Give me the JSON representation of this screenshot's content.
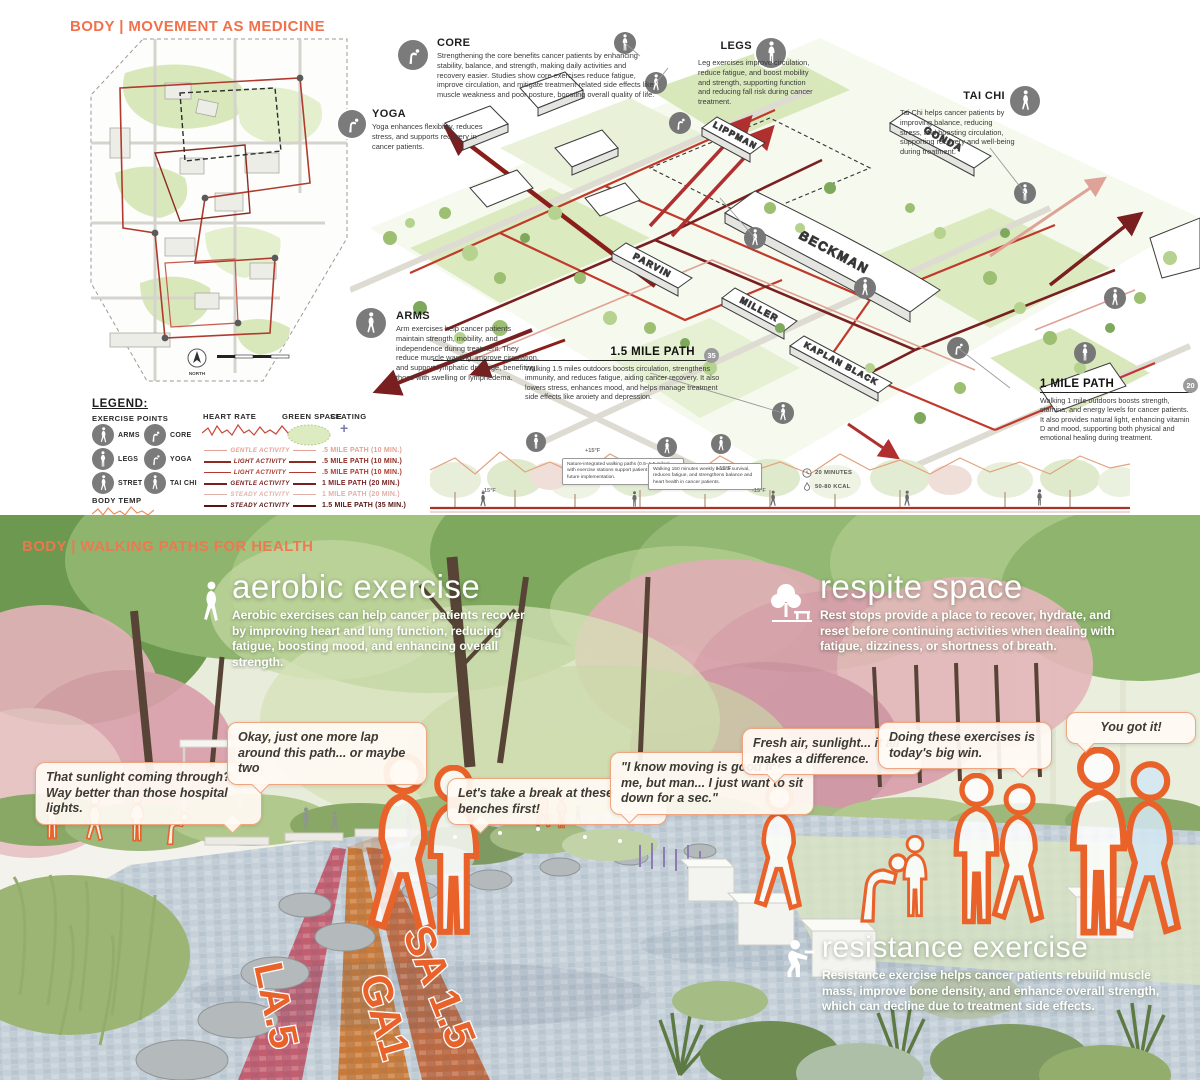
{
  "top": {
    "title": "BODY  |  MOVEMENT AS MEDICINE",
    "map": {
      "north_label": "NORTH"
    },
    "buildings": {
      "lippman": "LIPPMAN",
      "gonda": "GONDA",
      "beckman": "BECKMAN",
      "parvin": "PARVIN",
      "miller": "MILLER",
      "kaplan_black": "KAPLAN BLACK"
    },
    "callouts": {
      "core": {
        "title": "CORE",
        "text": "Strengthening the core benefits cancer patients by enhancing stability, balance, and strength, making daily activities and recovery easier. Studies show core exercises reduce fatigue, improve circulation, and mitigate treatment-related side effects like muscle weakness and poor posture, boosting overall quality of life."
      },
      "legs": {
        "title": "LEGS",
        "text": "Leg exercises improve circulation, reduce fatigue, and boost mobility and strength, supporting function and reducing fall risk during cancer treatment."
      },
      "tai_chi": {
        "title": "TAI CHI",
        "text": "Tai Chi helps cancer patients by improving balance, reducing stress, and boosting circulation, supporting recovery and well-being during treatment."
      },
      "yoga": {
        "title": "YOGA",
        "text": "Yoga enhances flexibility, reduces stress, and supports recovery in cancer patients."
      },
      "arms": {
        "title": "ARMS",
        "text": "Arm exercises help cancer patients maintain strength, mobility, and independence during treatment. They reduce muscle wasting, improve circulation, and support lymphatic drainage, benefiting those with swelling or lymphedema."
      },
      "path_15": {
        "title": "1.5 MILE PATH",
        "badge": "35",
        "text": "Walking 1.5 miles outdoors boosts circulation, strengthens immunity, and reduces fatigue, aiding cancer recovery. It also lowers stress, enhances mood, and helps manage treatment side effects like anxiety and depression."
      },
      "path_1": {
        "title": "1 MILE PATH",
        "badge": "20",
        "text": "Walking 1 mile outdoors boosts strength, stamina, and energy levels for cancer patients. It also provides natural light, enhancing vitamin D and mood, supporting both physical and emotional healing during treatment."
      }
    },
    "legend": {
      "heading": "LEGEND:",
      "exercise_points_label": "EXERCISE POINTS",
      "points": [
        "ARMS",
        "CORE",
        "LEGS",
        "YOGA",
        "STRETCH",
        "TAI CHI"
      ],
      "heart_rate_label": "HEART RATE",
      "green_space_label": "GREEN SPACE",
      "seating_label": "SEATING",
      "body_temp_label": "BODY TEMP",
      "activities": [
        {
          "name": "GENTLE ACTIVITY",
          "path": ".5 MILE PATH (10 MIN.)"
        },
        {
          "name": "LIGHT ACTIVITY",
          "path": ".5 MILE PATH (10 MIN.)"
        },
        {
          "name": "LIGHT ACTIVITY",
          "path": ".5 MILE PATH (10 MIN.)"
        },
        {
          "name": "GENTLE ACTIVITY",
          "path": "1 MILE PATH (20 MIN.)"
        },
        {
          "name": "STEADY ACTIVITY",
          "path": "1 MILE PATH (20 MIN.)"
        },
        {
          "name": "STEADY ACTIVITY",
          "path": "1.5 MILE PATH (35 MIN.)"
        }
      ]
    },
    "section": {
      "note_1": "Nature-integrated walking paths (0.5–1.5 miles) with exercise stations support patient wellbeing and future implementation.",
      "note_2": "Walking 150 minutes weekly boosts survival, reduces fatigue, and strengthens balance and heart health in cancer patients.",
      "temp_labels": [
        "-15°F",
        "+15°F",
        "+15°F",
        "-15°F"
      ],
      "duration_label": "20 MINUTES",
      "calories_label": "50-80 KCAL"
    }
  },
  "bottom": {
    "title": "BODY  |  WALKING PATHS FOR HEALTH",
    "features": {
      "aerobic": {
        "title": "aerobic exercise",
        "text": "Aerobic exercises can help cancer patients recover by improving heart and lung function, reducing fatigue, boosting mood, and enhancing overall strength."
      },
      "respite": {
        "title": "respite space",
        "text": "Rest stops provide a place to recover, hydrate, and reset before continuing activities when dealing with fatigue, dizziness, or shortness of breath."
      },
      "resistance": {
        "title": "resistance exercise",
        "text": "Resistance exercise helps cancer patients rebuild muscle mass, improve bone density, and enhance overall strength, which can decline due to treatment side effects."
      }
    },
    "bubbles": [
      "That sunlight coming through? Way better than those hospital lights.",
      "Okay, just one more lap around this path... or maybe two",
      "Let's take a break at these benches first!",
      "\"I know moving is good for me, but man... I just want to sit down for a sec.\"",
      "Fresh air, sunlight... it all makes a difference.",
      "Doing these exercises is today's big win.",
      "You got it!"
    ],
    "path_labels": {
      "la5": "LA.5",
      "ga1": "GA1",
      "sa15": "SA 1.5"
    }
  },
  "colors": {
    "accent_orange": "#F0714B",
    "outline_orange": "#E8622A",
    "path_dark_red": "#7A1F1F",
    "path_red": "#C0392B",
    "path_light_red": "#E2A295",
    "green_space": "#CFE3AE"
  }
}
